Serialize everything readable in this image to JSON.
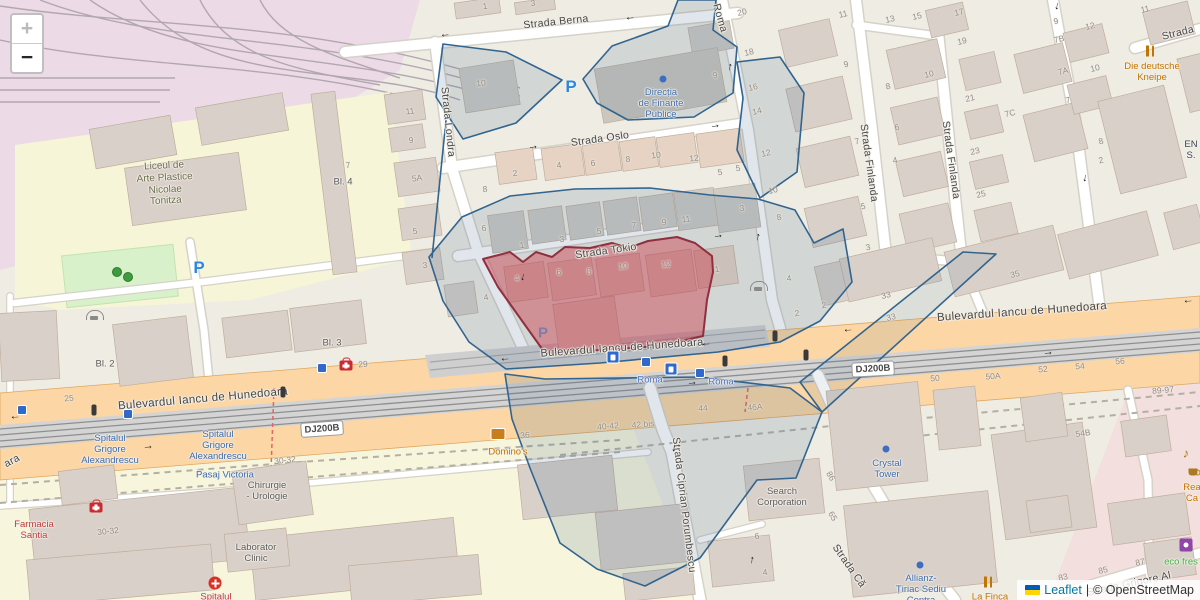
{
  "map": {
    "controls": {
      "zoom_in": "+",
      "zoom_out": "−"
    },
    "attribution": {
      "flag_icon": "ukraine-flag-icon",
      "leaflet_label": "Leaflet",
      "separator": "|",
      "osm_label": "© OpenStreetMap"
    },
    "colors": {
      "selection_fill": "#cd3c4b",
      "selection_stroke": "#8f2f40",
      "zone_fill": "#46698c",
      "zone_stroke": "#31648f",
      "road_primary": "#fcd6a4",
      "poi_blue": "#3f6ba8",
      "poi_red": "#c03a3a",
      "poi_orange": "#c27400",
      "poi_green": "#3cb23c",
      "parking_blue": "#2d87e0",
      "leaflet_link": "#0078a8"
    },
    "street_labels": [
      {
        "text": "Strada Berna",
        "x": 556,
        "y": 22,
        "rot": -6
      },
      {
        "text": "Strada Oslo",
        "x": 600,
        "y": 139,
        "rot": -8
      },
      {
        "text": "Strada Tokio",
        "x": 606,
        "y": 251,
        "rot": -8
      },
      {
        "text": "Strada Londra",
        "x": 448,
        "y": 122,
        "rot": 84
      },
      {
        "text": "Roma",
        "x": 720,
        "y": 18,
        "rot": 74
      },
      {
        "text": "Strada Finlanda",
        "x": 869,
        "y": 163,
        "rot": 82
      },
      {
        "text": "Strada Finlanda",
        "x": 951,
        "y": 160,
        "rot": 82
      },
      {
        "text": "Strada Ciprian Porumbescu",
        "x": 684,
        "y": 505,
        "rot": 83
      },
      {
        "text": "Strada Că",
        "x": 849,
        "y": 566,
        "rot": 55
      },
      {
        "text": "Strada Grigore Al",
        "x": 1129,
        "y": 584,
        "rot": -12
      },
      {
        "text": "Strada",
        "x": 1178,
        "y": 33,
        "rot": -14
      },
      {
        "text": "Bulevardul Iancu de Hunedoara",
        "x": 203,
        "y": 399,
        "rot": -5,
        "size": 11.5
      },
      {
        "text": "Bulevardul Iancu de Hunedoara",
        "x": 622,
        "y": 348,
        "rot": -4,
        "size": 11
      },
      {
        "text": "Bulevardul Iancu de Hunedoara",
        "x": 1022,
        "y": 312,
        "rot": -4,
        "size": 11.5
      },
      {
        "text": "ara",
        "x": 12,
        "y": 461,
        "rot": -28
      }
    ],
    "road_badges": [
      {
        "text": "DJ200B",
        "x": 322,
        "y": 429,
        "rot": -4
      },
      {
        "text": "DJ200B",
        "x": 873,
        "y": 369,
        "rot": -3
      }
    ],
    "poi_labels": [
      {
        "name": "school-label",
        "x": 165,
        "y": 184,
        "cls": "c-olive",
        "size": 10,
        "rot": -3,
        "lines": [
          "Liceul de",
          "Arte Plastice",
          "Nicolae",
          "Tonitza"
        ]
      },
      {
        "name": "finante-publice-label",
        "x": 661,
        "y": 104,
        "cls": "c-blue",
        "lines": [
          "Direcția",
          "de Finanțe",
          "Publice"
        ]
      },
      {
        "name": "hospital-label-1",
        "x": 110,
        "y": 450,
        "cls": "c-blue",
        "lines": [
          "Spitalul",
          "Grigore",
          "Alexandrescu"
        ]
      },
      {
        "name": "hospital-label-2",
        "x": 218,
        "y": 446,
        "cls": "c-blue",
        "lines": [
          "Spitalul",
          "Grigore",
          "Alexandrescu"
        ]
      },
      {
        "name": "pasaj-victoria-label",
        "x": 225,
        "y": 475,
        "cls": "c-blue",
        "lines": [
          "Pasaj Victoria"
        ]
      },
      {
        "name": "chirurgie-urologie-label",
        "x": 267,
        "y": 491,
        "cls": "c-gray",
        "lines": [
          "Chirurgie",
          "- Urologie"
        ]
      },
      {
        "name": "farmacia-santia-label",
        "x": 34,
        "y": 530,
        "cls": "c-red",
        "lines": [
          "Farmacia",
          "Santia"
        ]
      },
      {
        "name": "laborator-clinic-label",
        "x": 256,
        "y": 553,
        "cls": "c-gray",
        "lines": [
          "Laborator",
          "Clinic"
        ]
      },
      {
        "name": "spitalul-label",
        "x": 216,
        "y": 597,
        "cls": "c-red",
        "lines": [
          "Spitalul"
        ]
      },
      {
        "name": "search-corporation-label",
        "x": 782,
        "y": 497,
        "cls": "c-gray",
        "lines": [
          "Search",
          "Corporation"
        ]
      },
      {
        "name": "crystal-tower-label",
        "x": 887,
        "y": 469,
        "cls": "c-blue",
        "lines": [
          "Crystal",
          "Tower"
        ]
      },
      {
        "name": "allianz-label",
        "x": 921,
        "y": 590,
        "cls": "c-blue",
        "lines": [
          "Allianz-",
          "Țiriac Sediu",
          "Centra"
        ]
      },
      {
        "name": "la-finca-label",
        "x": 990,
        "y": 597,
        "cls": "c-orange",
        "lines": [
          "La Finca"
        ]
      },
      {
        "name": "deutsche-kneipe-label",
        "x": 1152,
        "y": 72,
        "cls": "c-orange",
        "lines": [
          "Die deutsche",
          "Kneipe"
        ]
      },
      {
        "name": "dominos-label",
        "x": 508,
        "y": 452,
        "cls": "c-orange",
        "lines": [
          "Domino's"
        ]
      },
      {
        "name": "eco-fresh-label",
        "x": 1181,
        "y": 562,
        "cls": "c-green",
        "lines": [
          "eco fres"
        ]
      },
      {
        "name": "rea-ca-label",
        "x": 1192,
        "y": 493,
        "cls": "c-orange",
        "lines": [
          "Rea",
          "Ca"
        ]
      },
      {
        "name": "en-label",
        "x": 1191,
        "y": 150,
        "cls": "c-dark",
        "lines": [
          "EN",
          "S."
        ]
      },
      {
        "name": "roma-tram-stop-label-1",
        "x": 650,
        "y": 380,
        "cls": "c-tram",
        "lines": [
          "Roma"
        ]
      },
      {
        "name": "roma-tram-stop-label-2",
        "x": 721,
        "y": 382,
        "cls": "c-tram",
        "lines": [
          "Roma"
        ]
      },
      {
        "name": "bl2-label",
        "x": 105,
        "y": 364,
        "cls": "c-gray",
        "lines": [
          "Bl. 2"
        ]
      },
      {
        "name": "bl3-label",
        "x": 332,
        "y": 343,
        "cls": "c-gray",
        "lines": [
          "Bl. 3"
        ]
      },
      {
        "name": "bl4-label",
        "x": 343,
        "y": 182,
        "cls": "c-gray",
        "lines": [
          "Bl. 4"
        ]
      }
    ],
    "house_numbers": [
      [
        "1",
        485,
        6
      ],
      [
        "3",
        533,
        3
      ],
      [
        "10",
        481,
        83
      ],
      [
        "9",
        715,
        75
      ],
      [
        "20",
        742,
        12,
        -13
      ],
      [
        "18",
        749,
        52,
        -13
      ],
      [
        "16",
        753,
        87,
        -13
      ],
      [
        "14",
        757,
        111,
        -13
      ],
      [
        "12",
        766,
        153,
        -13
      ],
      [
        "10",
        773,
        190,
        -13
      ],
      [
        "8",
        779,
        217,
        -13
      ],
      [
        "11",
        843,
        14,
        -13
      ],
      [
        "9",
        846,
        64,
        -13
      ],
      [
        "7",
        857,
        141,
        -13
      ],
      [
        "13",
        890,
        19,
        -13
      ],
      [
        "15",
        917,
        16,
        -13
      ],
      [
        "17",
        959,
        12,
        -13
      ],
      [
        "19",
        962,
        41,
        -13
      ],
      [
        "10",
        929,
        74,
        -13
      ],
      [
        "8",
        888,
        86,
        -13
      ],
      [
        "21",
        970,
        98,
        -13
      ],
      [
        "7C",
        1010,
        113,
        -13
      ],
      [
        "6",
        897,
        127,
        -13
      ],
      [
        "23",
        975,
        151,
        -13
      ],
      [
        "4",
        895,
        160,
        -13
      ],
      [
        "25",
        981,
        194,
        -13
      ],
      [
        "5",
        863,
        206,
        -13
      ],
      [
        "3",
        868,
        247,
        -13
      ],
      [
        "33",
        886,
        295,
        -13
      ],
      [
        "33",
        891,
        317,
        -13
      ],
      [
        "35",
        1015,
        274,
        -13
      ],
      [
        "9",
        1056,
        21,
        -14
      ],
      [
        "7B",
        1059,
        39,
        -14
      ],
      [
        "12",
        1090,
        26,
        -14
      ],
      [
        "7A",
        1063,
        71,
        -14
      ],
      [
        "10",
        1095,
        68,
        -14
      ],
      [
        "7",
        1068,
        100,
        -14
      ],
      [
        "8",
        1101,
        141,
        -14
      ],
      [
        "2",
        1101,
        160,
        -14
      ],
      [
        "11",
        1145,
        9,
        -14
      ],
      [
        "11",
        410,
        111
      ],
      [
        "9",
        411,
        140
      ],
      [
        "5A",
        417,
        178
      ],
      [
        "5",
        415,
        231
      ],
      [
        "3",
        425,
        265
      ],
      [
        "7",
        348,
        165
      ],
      [
        "2",
        515,
        173
      ],
      [
        "4",
        559,
        165
      ],
      [
        "6",
        593,
        163
      ],
      [
        "8",
        628,
        159
      ],
      [
        "10",
        656,
        155
      ],
      [
        "12",
        694,
        158
      ],
      [
        "5",
        720,
        172
      ],
      [
        "5",
        738,
        168
      ],
      [
        "8",
        485,
        189
      ],
      [
        "6",
        484,
        228
      ],
      [
        "1",
        522,
        245
      ],
      [
        "3",
        562,
        239
      ],
      [
        "5",
        599,
        231
      ],
      [
        "7",
        634,
        225
      ],
      [
        "9",
        664,
        222
      ],
      [
        "11",
        686,
        219
      ],
      [
        "3",
        742,
        208
      ],
      [
        "4",
        517,
        278
      ],
      [
        "6",
        559,
        272
      ],
      [
        "8",
        589,
        271
      ],
      [
        "10",
        623,
        266
      ],
      [
        "12",
        666,
        264
      ],
      [
        "4",
        486,
        297
      ],
      [
        "1",
        717,
        269
      ],
      [
        "4",
        789,
        278
      ],
      [
        "2",
        824,
        305
      ],
      [
        "2",
        797,
        313
      ],
      [
        "44",
        703,
        408,
        -5
      ],
      [
        "42 bis",
        643,
        424,
        -5
      ],
      [
        "40-42",
        608,
        426,
        -5
      ],
      [
        "36",
        525,
        435,
        -5
      ],
      [
        "46A",
        755,
        407,
        -5
      ],
      [
        "50",
        935,
        378,
        -5
      ],
      [
        "50A",
        993,
        376,
        -5
      ],
      [
        "52",
        1043,
        369,
        -5
      ],
      [
        "54",
        1080,
        366,
        -5
      ],
      [
        "56",
        1120,
        361,
        -5
      ],
      [
        "89-97",
        1163,
        390,
        -5
      ],
      [
        "25",
        69,
        398,
        -5
      ],
      [
        "29",
        363,
        364,
        -5
      ],
      [
        "30-32",
        285,
        460,
        -6
      ],
      [
        "30-32",
        108,
        531,
        -6
      ],
      [
        "54B",
        1083,
        433,
        -8
      ],
      [
        "83",
        1063,
        577,
        -12
      ],
      [
        "85",
        1103,
        570,
        -12
      ],
      [
        "87",
        1140,
        562,
        -12
      ],
      [
        "86",
        831,
        476,
        60
      ],
      [
        "65",
        833,
        516,
        60
      ],
      [
        "6",
        757,
        536
      ],
      [
        "4",
        765,
        572
      ]
    ],
    "arrows": [
      [
        "←",
        445,
        34,
        -6
      ],
      [
        "←",
        630,
        17,
        -6
      ],
      [
        "→",
        533,
        146,
        -8
      ],
      [
        "→",
        715,
        125,
        -8
      ],
      [
        "→",
        718,
        235,
        -8
      ],
      [
        "↑",
        730,
        67,
        10
      ],
      [
        "↑",
        758,
        237,
        10
      ],
      [
        "↓",
        523,
        277,
        12
      ],
      [
        "↓",
        1057,
        6,
        8
      ],
      [
        "↓",
        1085,
        178,
        8
      ],
      [
        "↓",
        674,
        448,
        8
      ],
      [
        "↑",
        752,
        560,
        8
      ],
      [
        "←",
        505,
        358,
        -4
      ],
      [
        "←",
        706,
        343,
        -4
      ],
      [
        "←",
        848,
        329,
        -4
      ],
      [
        "←",
        1188,
        300,
        -4
      ],
      [
        "←",
        15,
        416,
        -4
      ],
      [
        "→",
        148,
        446,
        -4
      ],
      [
        "→",
        692,
        382,
        -4
      ],
      [
        "→",
        1048,
        352,
        -4
      ]
    ],
    "icons": [
      [
        "tram-stop-icon",
        613,
        357
      ],
      [
        "tram-stop-icon",
        671,
        369
      ],
      [
        "tram-square-icon",
        646,
        362
      ],
      [
        "tram-square-icon",
        700,
        373
      ],
      [
        "tram-square-icon",
        322,
        368
      ],
      [
        "tram-square-icon",
        22,
        410
      ],
      [
        "tram-square-icon",
        128,
        414
      ],
      [
        "traffic-light-icon",
        94,
        410
      ],
      [
        "traffic-light-icon",
        283,
        392
      ],
      [
        "traffic-light-icon",
        725,
        361
      ],
      [
        "traffic-light-icon",
        775,
        336
      ],
      [
        "traffic-light-icon",
        806,
        355
      ],
      [
        "pharmacy-kit-icon",
        96,
        506
      ],
      [
        "pharmacy-kit-icon",
        346,
        364
      ],
      [
        "hospital-cross-icon",
        215,
        583
      ],
      [
        "car-shelter-icon",
        95,
        315
      ],
      [
        "car-shelter-icon",
        759,
        286
      ],
      [
        "fork-knife-icon",
        1150,
        51
      ],
      [
        "fork-knife-icon",
        988,
        582
      ],
      [
        "music-note-icon",
        1186,
        453
      ],
      [
        "cup-icon",
        1193,
        472
      ],
      [
        "poi-dot-icon",
        663,
        79
      ],
      [
        "poi-dot-icon",
        886,
        449
      ],
      [
        "poi-dot-icon",
        920,
        565
      ],
      [
        "tree-icon",
        117,
        272
      ],
      [
        "tree-icon",
        128,
        277
      ],
      [
        "purple-square-icon",
        1186,
        545
      ],
      [
        "dominos-icon",
        498,
        434
      ],
      [
        "parking-icon",
        571,
        87
      ],
      [
        "parking-icon",
        199,
        268
      ],
      [
        "parking-faded-icon",
        543,
        333
      ]
    ]
  }
}
